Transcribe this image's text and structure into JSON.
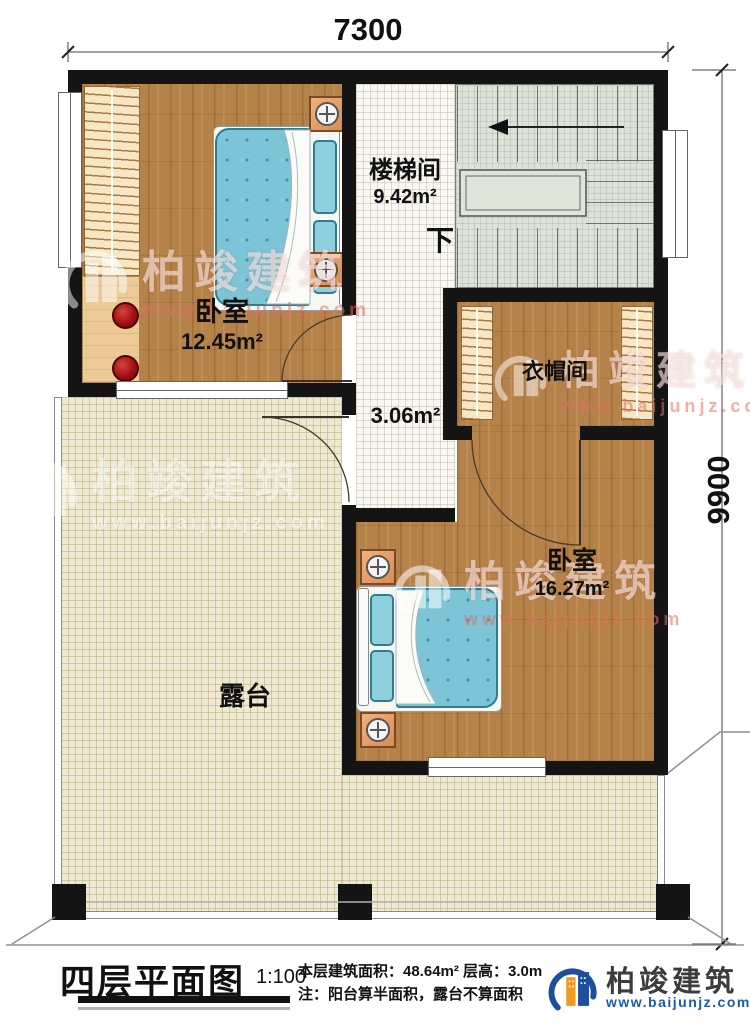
{
  "dimensions": {
    "top": "7300",
    "right": "9900"
  },
  "rooms": {
    "bedroom1": {
      "name": "卧室",
      "area": "12.45m²"
    },
    "bedroom2": {
      "name": "卧室",
      "area": "16.27m²"
    },
    "stairwell": {
      "name": "楼梯间",
      "area": "9.42m²",
      "direction": "下"
    },
    "cloakroom": {
      "name": "衣帽间"
    },
    "hallway": {
      "area": "3.06m²"
    },
    "terrace": {
      "name": "露台"
    }
  },
  "brand": {
    "name": "柏竣建筑",
    "url": "www.baijunjz.com"
  },
  "footer": {
    "plan_title": "四层平面图",
    "scale": "1:100",
    "stats": "本层建筑面积：48.64m²  层高：3.0m",
    "note": "注：阳台算半面积，露台不算面积"
  },
  "colors": {
    "wall": "#141414",
    "wood_floor": "#b5824a",
    "terrace_tile": "#efe9d4",
    "stair_floor": "#dde3d8",
    "mattress_blue": "#7cc4d6",
    "stool_red": "#a21010",
    "brand_blue": "#1d4f9c",
    "brand_orange": "#f29a1e"
  }
}
